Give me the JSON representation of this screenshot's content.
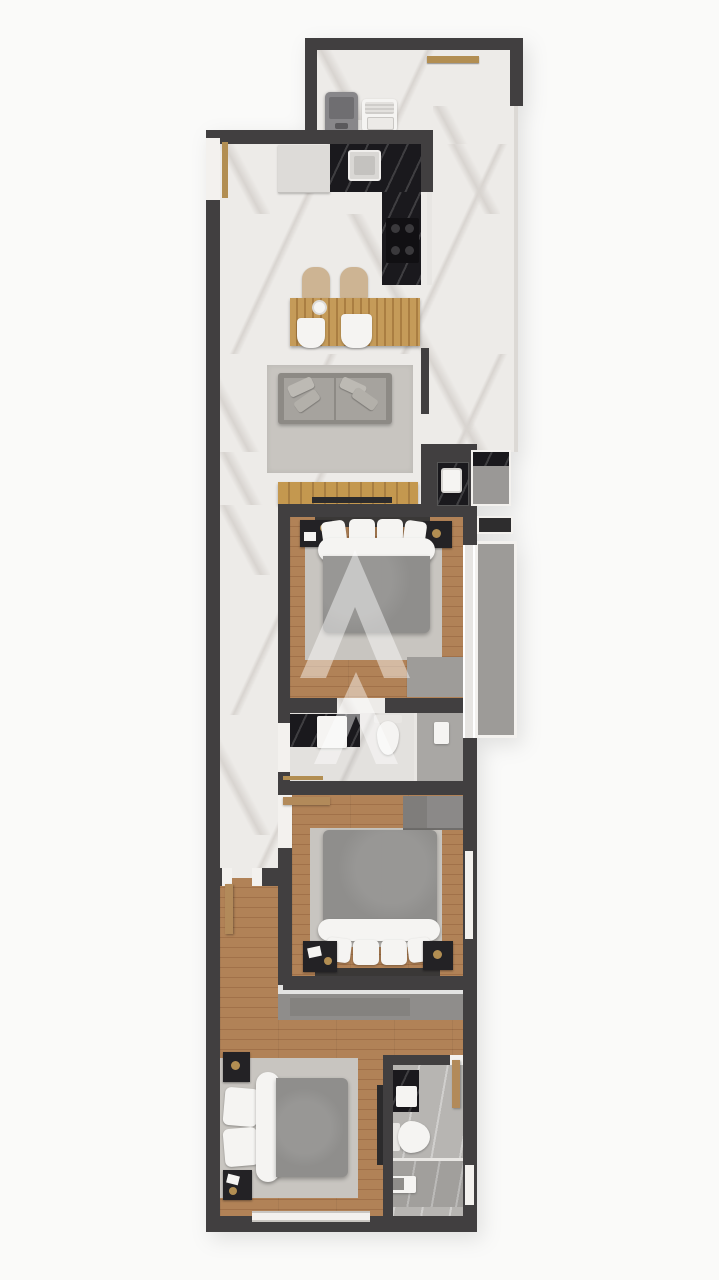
{
  "meta": {
    "type": "3d-apartment-floor-plan-render",
    "visible_text": ""
  },
  "palette": {
    "bg": "#fafaf9",
    "wall": "#413f40",
    "wallHi": "#f3f1ee",
    "marble": "#edebe8",
    "marbleVein": "#d8d4d0",
    "bathFloor": "#e3e1de",
    "showerFloor": "#a9a7a4",
    "bathFloor2": "#b7b5b2",
    "wood": "#b18257",
    "woodDark": "#a17149",
    "tableWood": "#b98e4e",
    "consoleWood": "#b9904e",
    "rug": "#c8c5c0",
    "sofa": "#a6a39e",
    "sofaFrame": "#8d8a85",
    "duvet": "#8f8e8c",
    "whiteItem": "#f5f4f2",
    "blackMarble": "#1a191d",
    "balconyFloor": "#9d9b98",
    "grayRoom": "#9a9896",
    "closet": "#8f8d8b",
    "wardrobe": "#8b8988",
    "gold": "#b28e52",
    "appliance": "#88878a",
    "doorWood": "#b28a5a",
    "tvDark": "#2c2b2c",
    "watermark": "rgba(255,255,255,0.45)"
  },
  "watermark": {
    "shape": "stylized-double-A-monogram",
    "color": "rgba(255,255,255,0.45)"
  },
  "rooms": [
    {
      "id": "laundry-service-area",
      "floor": "white-marble"
    },
    {
      "id": "kitchen",
      "floor": "white-marble"
    },
    {
      "id": "dining-area",
      "floor": "white-marble"
    },
    {
      "id": "living-room",
      "floor": "white-marble"
    },
    {
      "id": "hallway",
      "floor": "white-marble-then-wood"
    },
    {
      "id": "bedroom-1",
      "floor": "wood"
    },
    {
      "id": "balcony",
      "floor": "gray-tile"
    },
    {
      "id": "bathroom-1",
      "floor": "light-marble-with-shower"
    },
    {
      "id": "bedroom-2",
      "floor": "wood"
    },
    {
      "id": "bedroom-3",
      "floor": "wood"
    },
    {
      "id": "bathroom-2",
      "floor": "gray-marble-with-shower"
    }
  ],
  "furniture": [
    "washing-machine",
    "laundry-tub",
    "kitchen-cabinet",
    "kitchen-sink",
    "black-marble-counter",
    "cooktop",
    "dining-table",
    "dining-chairs",
    "sofa",
    "area-rug",
    "tv-console",
    "wash-basin-niche",
    "double-bed-1",
    "nightstands-1",
    "double-bed-2",
    "wardrobe",
    "nightstands-2",
    "double-bed-3",
    "nightstands-3",
    "vanity-sink-1",
    "toilet-1",
    "shower-1",
    "vanity-sink-2",
    "toilet-2",
    "shower-2",
    "built-in-closet",
    "entry-door",
    "interior-doors",
    "windows"
  ]
}
